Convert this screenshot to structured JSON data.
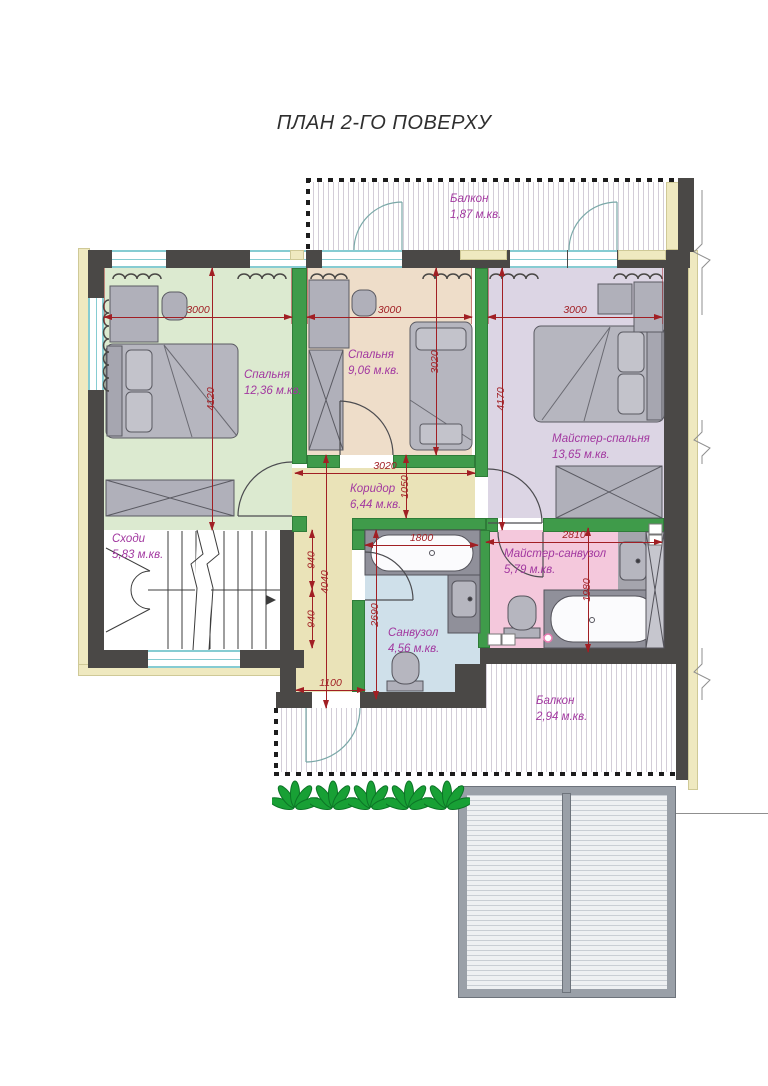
{
  "title": "ПЛАН 2-ГО ПОВЕРХУ",
  "rooms": {
    "balcony_top": {
      "name": "Балкон",
      "area": "1,87 м.кв."
    },
    "bedroom1": {
      "name": "Спальня",
      "area": "12,36 м.кв."
    },
    "bedroom2": {
      "name": "Спальня",
      "area": "9,06 м.кв."
    },
    "master_bedroom": {
      "name": "Майстер-спальня",
      "area": "13,65 м.кв."
    },
    "stairs": {
      "name": "Сходи",
      "area": "5,83 м.кв."
    },
    "corridor": {
      "name": "Коридор",
      "area": "6,44 м.кв."
    },
    "bathroom": {
      "name": "Санвузол",
      "area": "4,56 м.кв."
    },
    "master_bathroom": {
      "name": "Майстер-санвузол",
      "area": "5,79 м.кв."
    },
    "balcony_bottom": {
      "name": "Балкон",
      "area": "2,94 м.кв."
    }
  },
  "dims": {
    "bed1_w": "3000",
    "bed2_w": "3000",
    "master_w": "3000",
    "bed1_h": "4120",
    "bed2_h": "3020",
    "master_h": "4170",
    "corridor_w": "3020",
    "corridor_top_h": "1050",
    "seg_940_a": "940",
    "corridor_h": "4040",
    "seg_940_b": "940",
    "corridor_bottom_w": "1100",
    "tub_w": "1800",
    "bath_h": "2690",
    "mbath_w": "2810",
    "mbath_h": "1980"
  },
  "colors": {
    "wall": "#4a4846",
    "partition_green": "#3f9b4a",
    "dimension_red": "#a11f24",
    "room_label_purple": "#a238a0",
    "trim_yellow": "#efe9c0",
    "bedroom1_floor": "#dcead0",
    "bedroom2_floor": "#eeddc9",
    "master_bedroom_floor": "#dcd5e4",
    "corridor_floor": "#eae3b8",
    "bathroom_floor": "#cfe0ea",
    "master_bathroom_floor": "#f4c8dc",
    "fixture_gray": "#b0b0ba",
    "window_cyan": "#86ccd2",
    "plant_green": "#18a035"
  }
}
